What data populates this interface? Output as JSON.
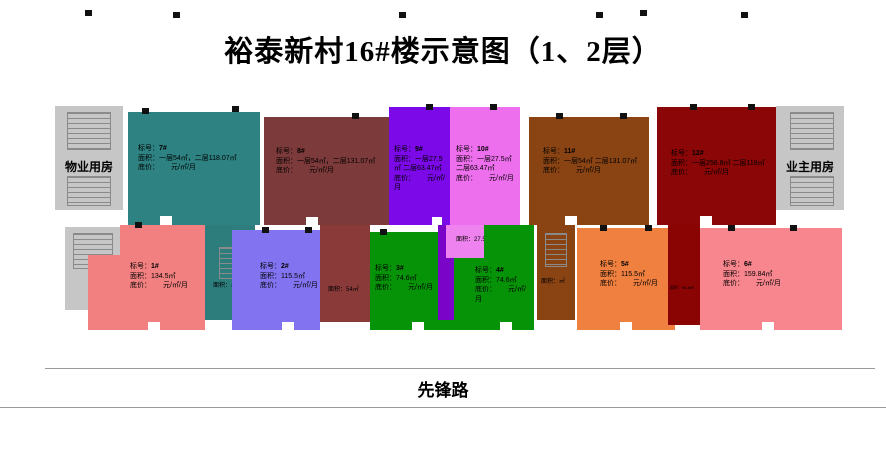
{
  "title": "裕泰新村16#楼示意图（1、2层）",
  "road": {
    "name": "先锋路"
  },
  "side_rooms": {
    "left": "物业用房",
    "right": "业主用房"
  },
  "labels": {
    "id": "标号：",
    "area": "面积：",
    "price": "底价："
  },
  "floor2_units": [
    {
      "id": "7#",
      "area": "一层54㎡，二层118.07㎡",
      "price": "元/㎡/月",
      "color": "#2e8282"
    },
    {
      "id": "8#",
      "area": "一层54㎡，二层131.07㎡",
      "price": "元/㎡/月",
      "color": "#7d3a3a"
    },
    {
      "id": "9#",
      "area": "一层27.5㎡ 二层63.47㎡",
      "price": "元/㎡/月",
      "color": "#7b09e8"
    },
    {
      "id": "10#",
      "area": "一层27.5㎡ 二层63.47㎡",
      "price": "元/㎡/月",
      "color": "#ee6fee"
    },
    {
      "id": "11#",
      "area": "一层54㎡ 二层131.07㎡",
      "price": "元/㎡/月",
      "color": "#8a4413"
    },
    {
      "id": "12#",
      "area": "一层256.8㎡ 二层118㎡",
      "price": "元/㎡/月",
      "color": "#8b0606"
    }
  ],
  "floor1_units": [
    {
      "id": "1#",
      "area": "134.5㎡",
      "price": "元/㎡/月",
      "color": "#f28080"
    },
    {
      "id": "2#",
      "area": "115.5㎡",
      "price": "元/㎡/月",
      "color": "#8273f0"
    },
    {
      "id": "3#",
      "area": "74.6㎡",
      "price": "元/㎡/月",
      "color": "#079307"
    },
    {
      "id": "4#",
      "area": "74.6㎡",
      "price": "元/㎡/月",
      "color": "#079307"
    },
    {
      "id": "5#",
      "area": "115.5㎡",
      "price": "元/㎡/月",
      "color": "#f08040"
    },
    {
      "id": "6#",
      "area": "159.84㎡",
      "price": "元/㎡/月",
      "color": "#f8868e"
    }
  ],
  "strips": {
    "between_1_2": {
      "area": "㎡",
      "color": "#2e7d7d"
    },
    "between_2_3": {
      "area": "54㎡",
      "color": "#8b3a3a"
    },
    "above_4": {
      "area": "27.5㎡",
      "color": "#ee82ee"
    },
    "between_4_5": {
      "area": "㎡",
      "color": "#8a4413"
    },
    "between_5_6": {
      "area": "96.8㎡",
      "color": "#8b0404"
    }
  }
}
